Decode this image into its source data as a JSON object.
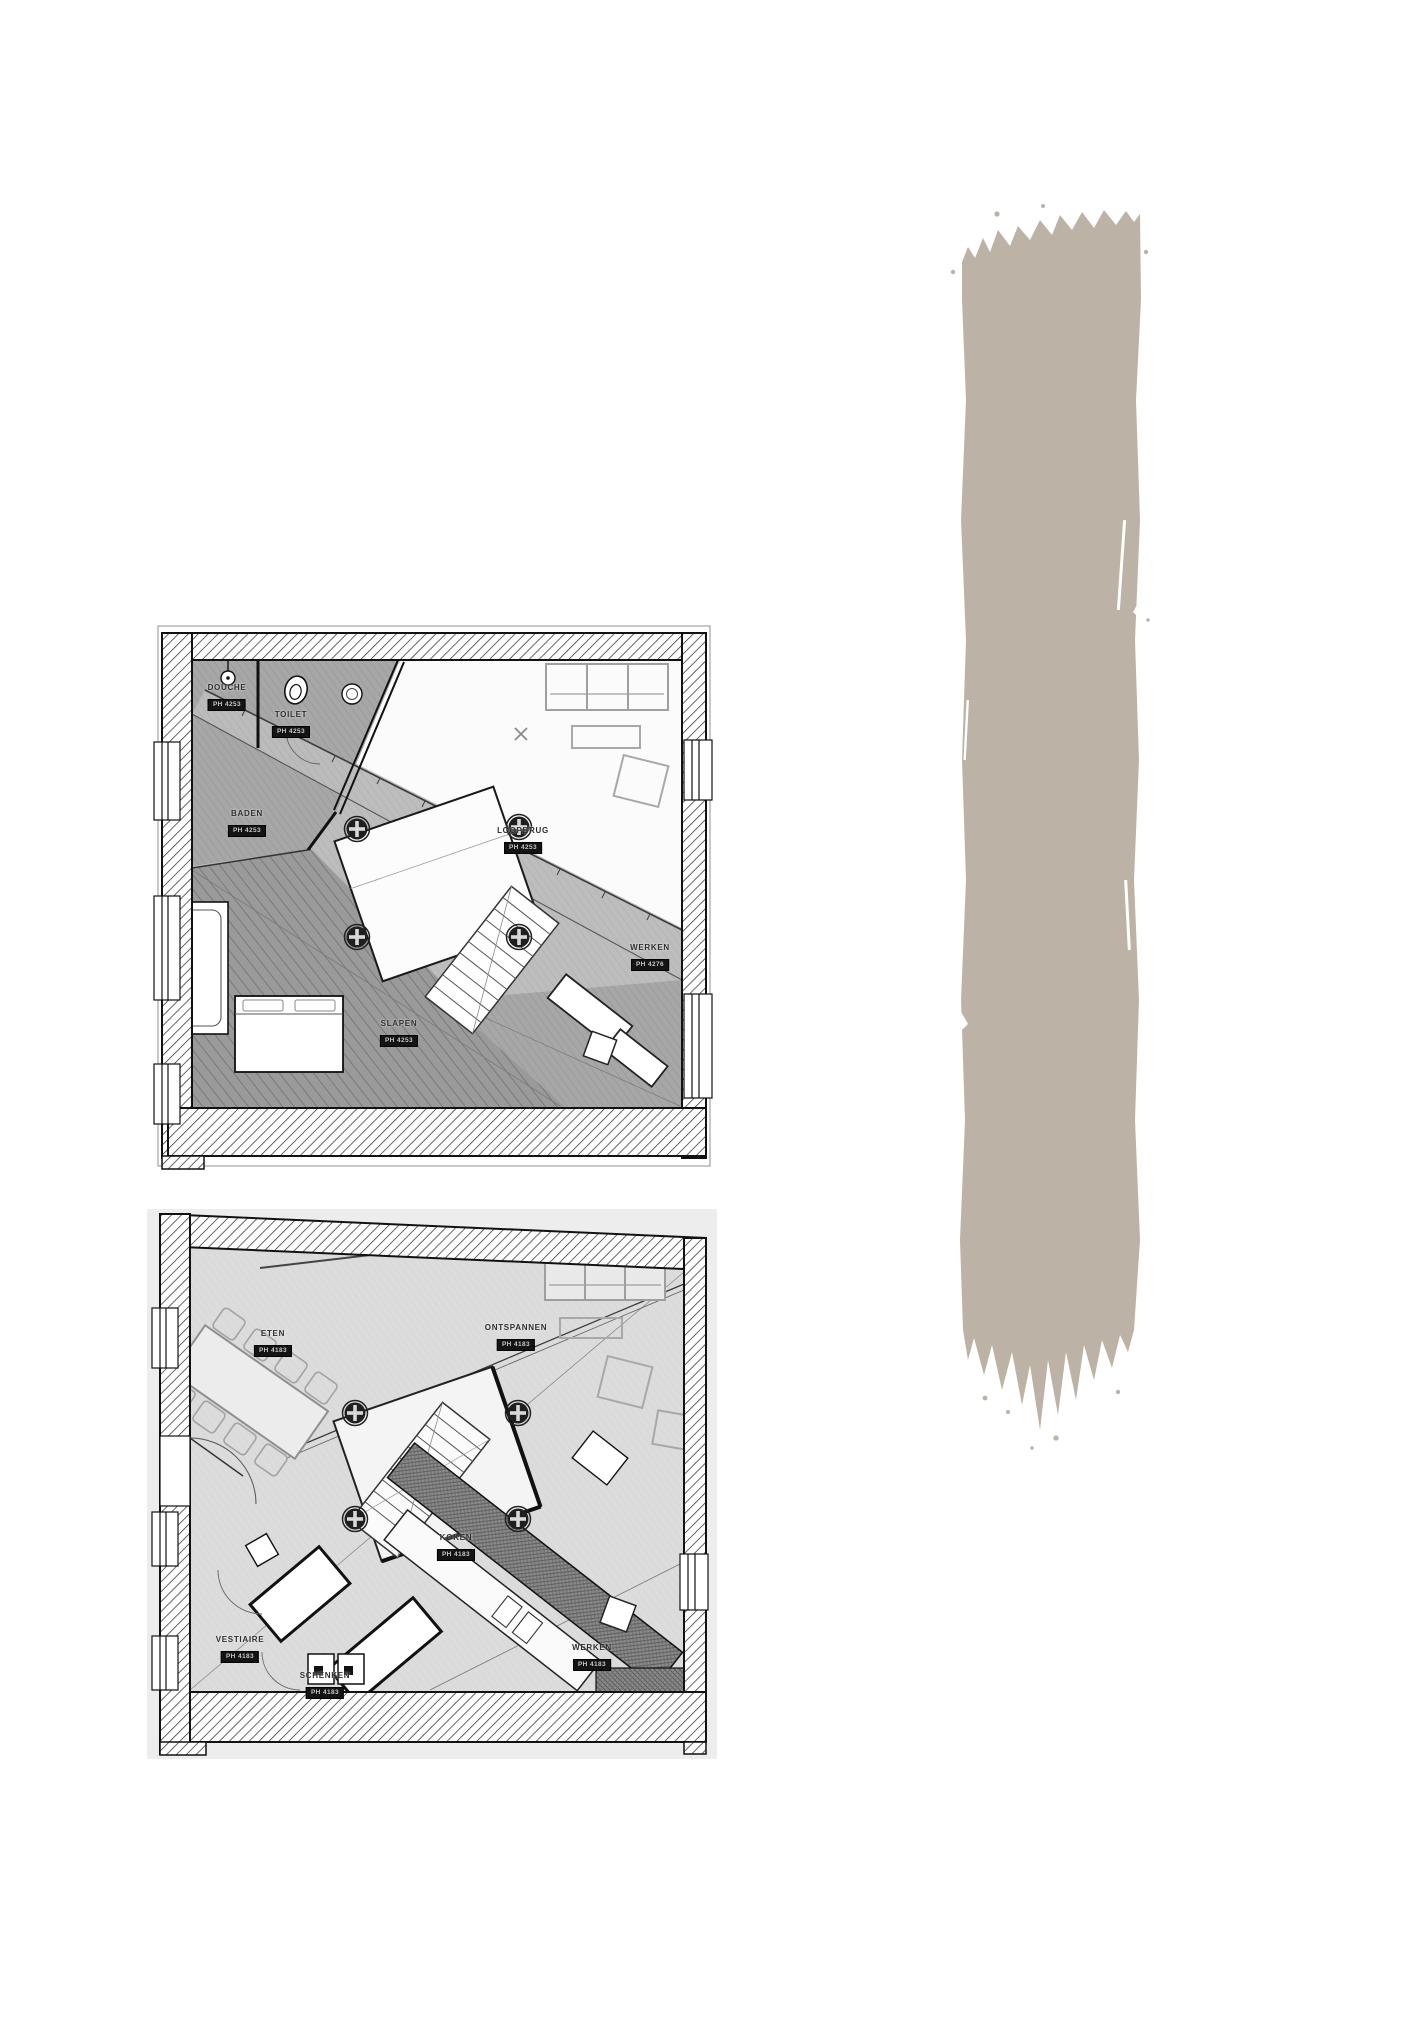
{
  "page": {
    "background_color": "#ffffff"
  },
  "artwork": {
    "brushstroke": {
      "color": "#bdb2a6",
      "description": "vertical dry paint brushstroke"
    }
  },
  "plans": [
    {
      "name": "upper-floor-plan",
      "rooms": [
        {
          "name": "DOUCHE",
          "level": "PH 4253"
        },
        {
          "name": "TOILET",
          "level": "PH 4253"
        },
        {
          "name": "BADEN",
          "level": "PH 4253"
        },
        {
          "name": "LOOPBRUG",
          "level": "PH 4253"
        },
        {
          "name": "SLAPEN",
          "level": "PH 4253"
        },
        {
          "name": "WERKEN",
          "level": "PH 4276"
        }
      ]
    },
    {
      "name": "ground-floor-plan",
      "rooms": [
        {
          "name": "ETEN",
          "level": "PH 4183"
        },
        {
          "name": "ONTSPANNEN",
          "level": "PH 4183"
        },
        {
          "name": "KOKEN",
          "level": "PH 4183"
        },
        {
          "name": "VESTIAIRE",
          "level": "PH 4183"
        },
        {
          "name": "SCHENKEN",
          "level": "PH 4183"
        },
        {
          "name": "WERKEN",
          "level": "PH 4183"
        }
      ]
    }
  ]
}
